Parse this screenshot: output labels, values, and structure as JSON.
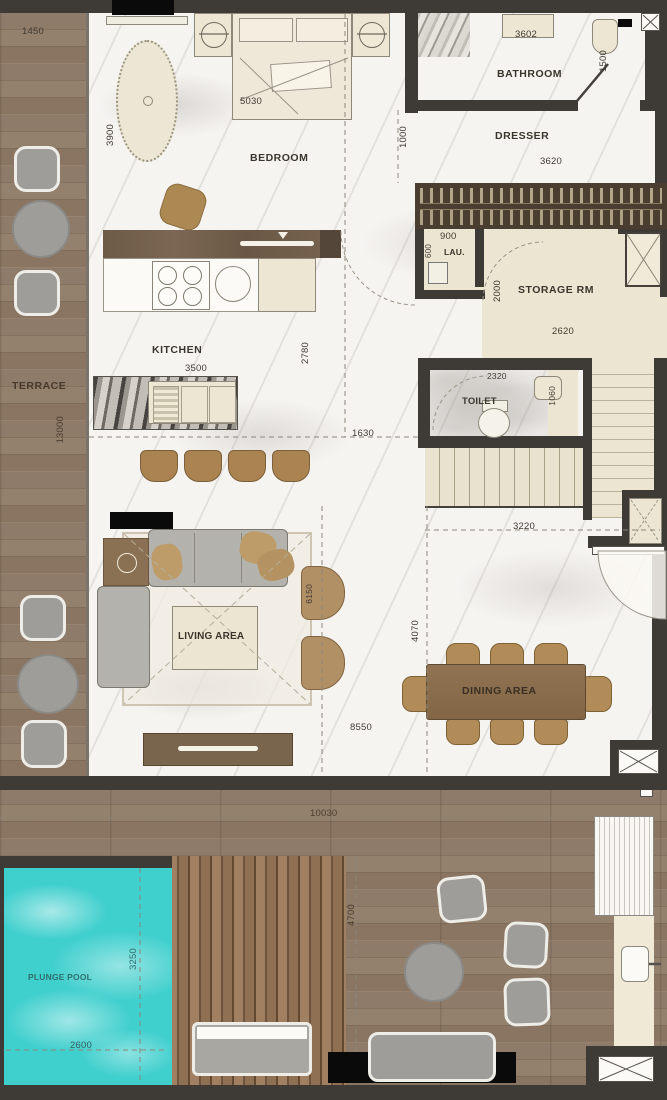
{
  "labels": {
    "terrace": "TERRACE",
    "bedroom": "BEDROOM",
    "bathroom": "BATHROOM",
    "dresser": "DRESSER",
    "laundry": "LAU.",
    "storage": "STORAGE RM",
    "toilet": "TOILET",
    "kitchen": "KITCHEN",
    "living": "LIVING AREA",
    "dining": "DINING AREA",
    "pool": "PLUNGE POOL"
  },
  "dimensions": {
    "d1450": "1450",
    "d3900": "3900",
    "d5030": "5030",
    "d3602": "3602",
    "d1500": "1500",
    "d1000": "1000",
    "d3620": "3620",
    "d900": "900",
    "d600": "600",
    "d2000": "2000",
    "d2620": "2620",
    "d2320": "2320",
    "d1060": "1060",
    "d3500": "3500",
    "d2780": "2780",
    "d1630": "1630",
    "d3220": "3220",
    "d13000": "13000",
    "d6150": "6150",
    "d8550": "8550",
    "d4070": "4070",
    "d10030": "10030",
    "d4700": "4700",
    "d3250": "3250",
    "d2600": "2600"
  },
  "colors": {
    "wall": "#3e3b37",
    "marble": "#f6f4f1",
    "wood": "#8a7765",
    "deck": "#997757",
    "beige": "#ece5d1",
    "pool": "#3fcfcd",
    "furniture_gray": "#9e9d9a",
    "tan": "#b18c58",
    "dark_wood": "#5f4e3d",
    "black": "#0a0a0a"
  }
}
